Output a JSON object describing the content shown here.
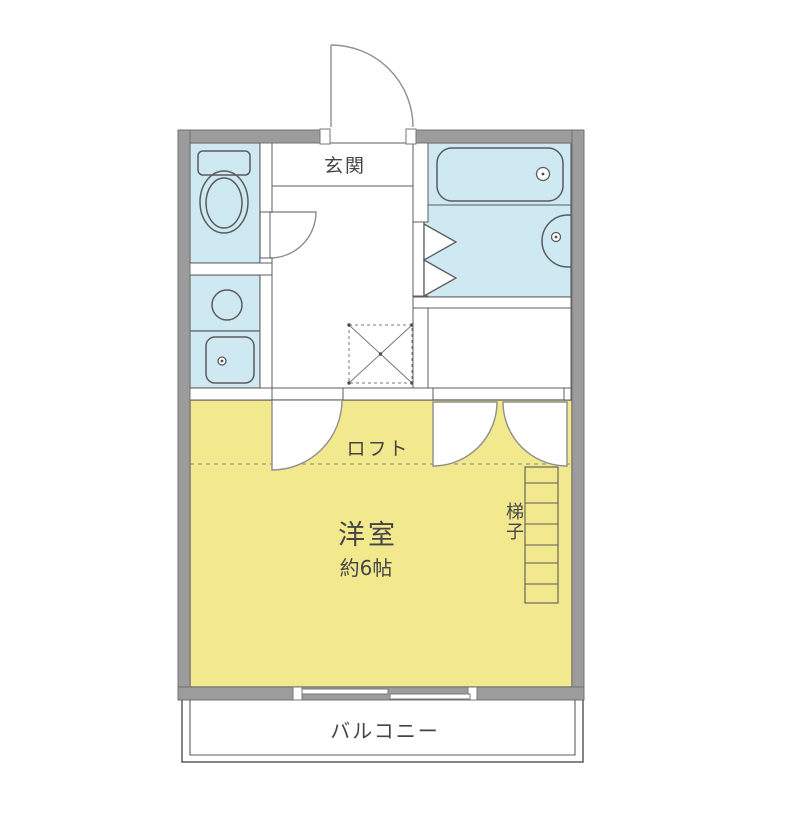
{
  "plan": {
    "labels": {
      "entrance": "玄関",
      "loft": "ロフト",
      "room_name": "洋室",
      "room_size": "約6帖",
      "ladder": "梯子",
      "balcony": "バルコニー"
    },
    "colors": {
      "wall": "#9c9c9c",
      "water_area": "#cee9f2",
      "room_area": "#f2e88e",
      "line": "#5c5c5c"
    }
  }
}
